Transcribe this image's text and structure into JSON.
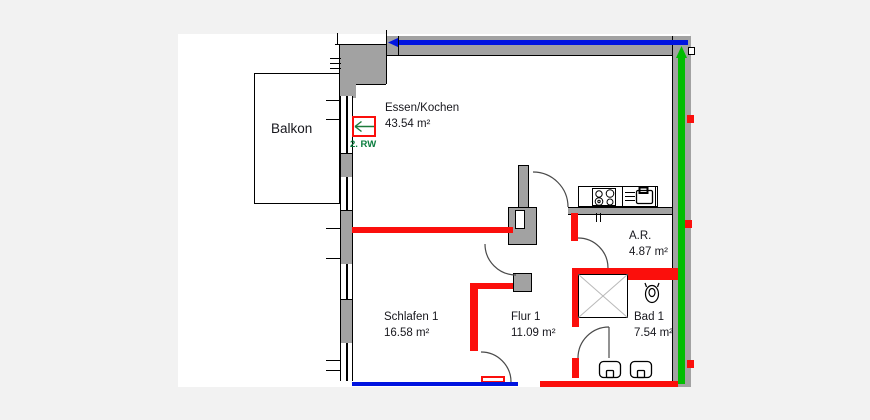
{
  "document_type": "floor-plan",
  "rooms": [
    {
      "name": "Balkon",
      "area": ""
    },
    {
      "name": "Essen/Kochen",
      "area": "43.54 m²"
    },
    {
      "name": "Schlafen 1",
      "area": "16.58 m²"
    },
    {
      "name": "Flur 1",
      "area": "11.09 m²"
    },
    {
      "name": "A.R.",
      "area": "4.87 m²"
    },
    {
      "name": "Bad 1",
      "area": "7.54 m²"
    }
  ],
  "markers": {
    "escape_route": "2. RW"
  },
  "colors": {
    "page_background": "#f2f2f2",
    "plan_background": "#ffffff",
    "wall_gray": "#a2a2a2",
    "highlight_red": "#fb0f0c",
    "highlight_blue": "#0014e0",
    "highlight_green": "#00bd00",
    "escape_label_green": "#0a7d3e"
  },
  "fixtures": [
    "stove-icon",
    "sink-icon",
    "shower-icon",
    "toilet-icon",
    "washbasin-icon",
    "door-swing-arc",
    "window-symbol",
    "escape-route-arrow"
  ]
}
